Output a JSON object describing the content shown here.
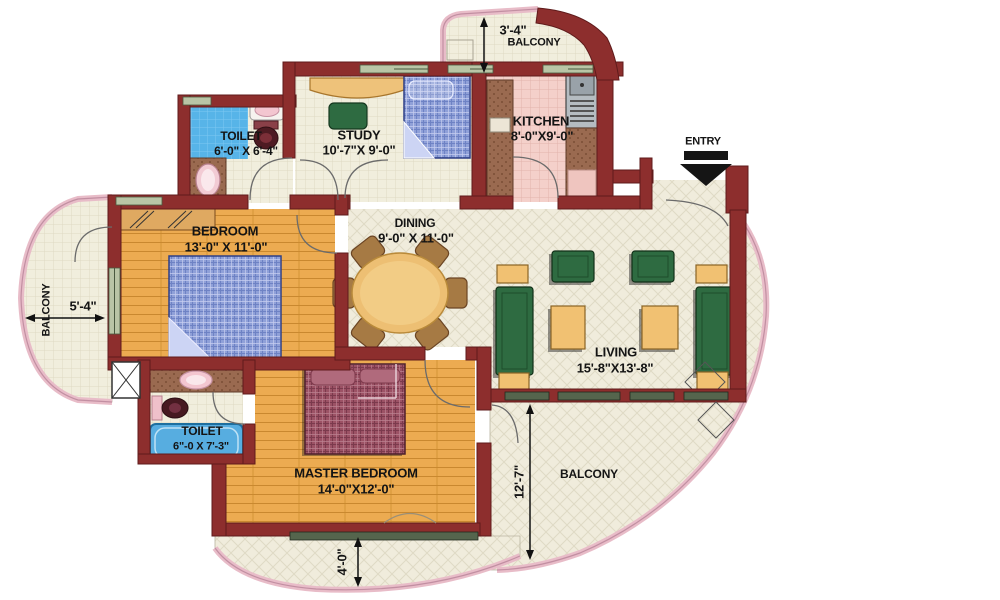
{
  "rooms": {
    "toilet_top": {
      "name": "TOILET",
      "dims": "6'-0\" X 6'-4\""
    },
    "study": {
      "name": "STUDY",
      "dims": "10'-7\"X 9'-0\""
    },
    "kitchen": {
      "name": "KITCHEN",
      "dims": "8'-0\"X9'-0\""
    },
    "bedroom": {
      "name": "BEDROOM",
      "dims": "13'-0\" X 11'-0\""
    },
    "dining": {
      "name": "DINING",
      "dims": "9'-0\" X 11'-0\""
    },
    "living": {
      "name": "LIVING",
      "dims": "15'-8\"X13'-8\""
    },
    "toilet_bottom": {
      "name": "TOILET",
      "dims": "6\"-0 X 7'-3\""
    },
    "master_bedroom": {
      "name": "MASTER BEDROOM",
      "dims": "14'-0\"X12'-0\""
    }
  },
  "balconies": {
    "top": {
      "label": "BALCONY",
      "dim": "3'-4\""
    },
    "left": {
      "label": "BALCONY",
      "dim": "5'-4\""
    },
    "right": {
      "label": "BALCONY",
      "dim": "12'-7\""
    },
    "bottom": {
      "dim": "4'-0\""
    }
  },
  "entry": {
    "label": "ENTRY"
  },
  "colors": {
    "wall": "#8d2e2d",
    "wood_floor": "#ecab51",
    "tile_floor": "#f0ecdc",
    "kitchen_floor": "#f4d0ca",
    "water_blue": "#57ade0",
    "sofa_green": "#2e6b41",
    "table_yellow": "#f1c172",
    "balcony_rail": "#e8bcc8",
    "dining_chair": "#a67a44",
    "bed_blue": "#8fa0d8",
    "bed_maroon": "#9c5265"
  }
}
